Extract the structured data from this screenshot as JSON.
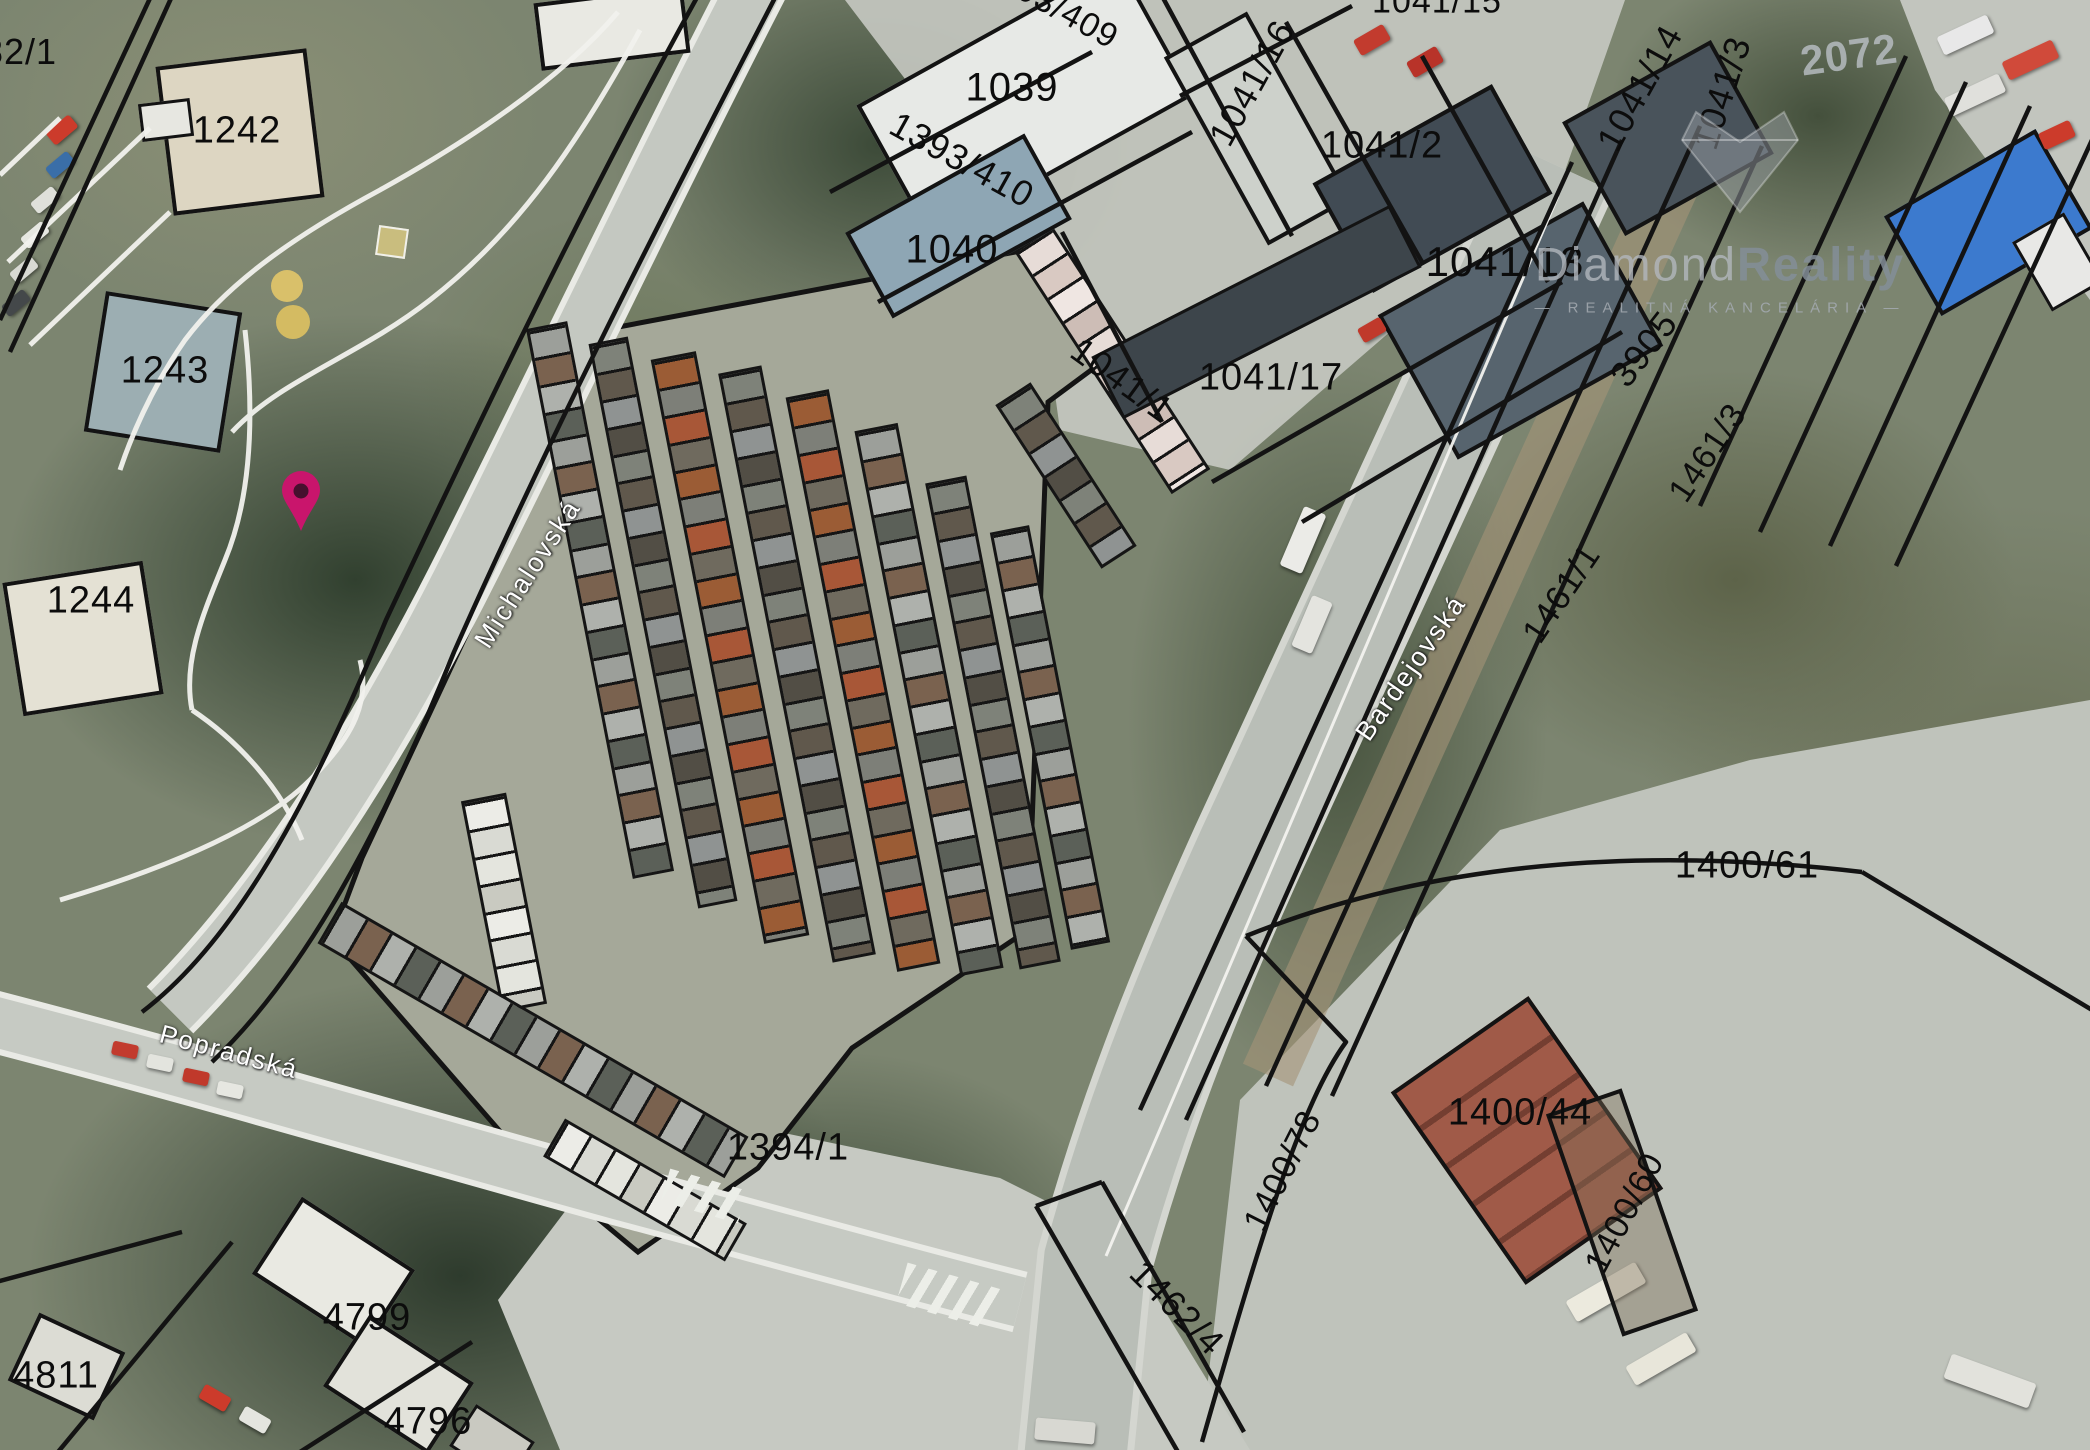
{
  "map": {
    "streets": {
      "michalovska": "Michalovská",
      "popradska": "Popradská",
      "bardejovska": "Bardejovská"
    },
    "parcels": {
      "p82_1": "82/1",
      "p1242": "1242",
      "p1243": "1243",
      "p1244": "1244",
      "p1039": "1039",
      "p1393_410": "1393/410",
      "p1393_409": "1393/409",
      "p1040": "1040",
      "p1041_15": "1041/15",
      "p1041_16": "1041/16",
      "p1041_2": "1041/2",
      "p1041_14": "1041/14",
      "p1041_13": "1041/13",
      "p1041_3": "1041/3",
      "p1041_1": "1041/1",
      "p1041_17": "1041/17",
      "p3905": "3905",
      "p1461_3": "1461/3",
      "p1461_1": "1461/1",
      "p2072": "2072",
      "p1400_61": "1400/61",
      "p1400_44": "1400/44",
      "p1400_60": "1400/60",
      "p1400_78": "1400/78",
      "p1394_1": "1394/1",
      "p1462_4": "1462/4",
      "p4799": "4799",
      "p4811": "4811",
      "p4796": "4796"
    },
    "watermark": {
      "brand_first": "Diamond",
      "brand_second": "Reality",
      "subtitle": "— REALITNÁ KANCELÁRIA —"
    },
    "colors": {
      "pin": "#c9156c",
      "cadastral_line": "#131313",
      "street_label": "#ffffff",
      "watermark_gray": "#9aa0a6"
    }
  }
}
